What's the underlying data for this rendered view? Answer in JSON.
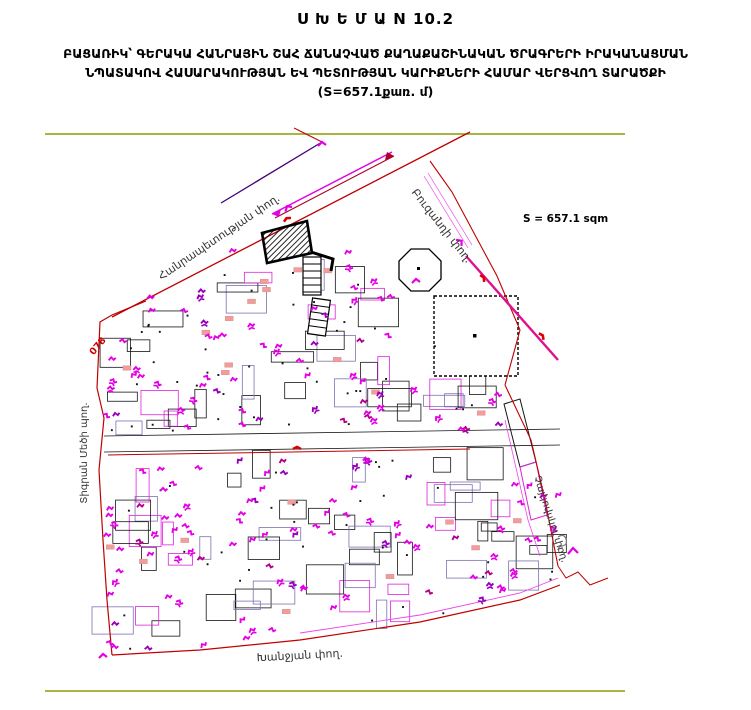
{
  "title": {
    "line1": "Ս Խ Ե Մ Ա N 10.2",
    "line2": "ԲԱՑԱՌԻԿ՝ ԳԵՐԱԿԱ ՀԱՆՐԱՅԻՆ ՇԱՀ ՃԱՆԱՉՎԱԾ ՔԱՂԱՔԱՇԻՆԱԿԱՆ ԾՐԱԳՐԵՐԻ ԻՐԱԿԱՆԱՑՄԱՆ",
    "line3": "ՆՊԱՏԱԿՈՎ ՀԱՍԱՐԱԿՈՒԹՅԱՆ ԵՎ ՊԵՏՈՒԹՅԱՆ ԿԱՐԻՔՆԵՐԻ ՀԱՄԱՐ ՎԵՐՑՎՈՂ ՏԱՐԱԾՔԻ",
    "line4": "(S=657.1քառ. մ)"
  },
  "map": {
    "area_label": "S = 657.1 sqm",
    "zone_code": "078",
    "streets": {
      "north": "Հանրապետության փող.",
      "northeast": "Բուզանդի փող.",
      "west": "Տիգրան Մեծի պող.",
      "south": "Խանջյան փող.",
      "east": "Չայկովսկու փող."
    },
    "colors": {
      "frame_olive": "#8e9c00",
      "street_red": "#c00000",
      "street_magenta_bold": "#e0108c",
      "street_magenta_thin": "#ee44ee",
      "street_purple": "#440077",
      "parcel_black": "#151515",
      "parcel_purple": "#8070b0",
      "parcel_magenta": "#dd22dd",
      "marker_magenta": "#e400e4",
      "marker_violet": "#9900bb",
      "pink_fill": "#f29c9c",
      "dot_black": "#111111",
      "label_gray": "#333333",
      "code_red": "#cc0000"
    }
  }
}
